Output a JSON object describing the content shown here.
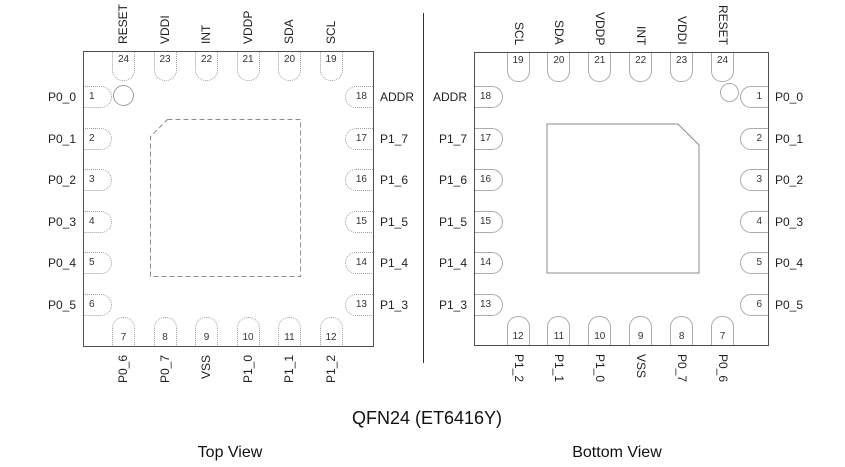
{
  "title": "QFN24 (ET6416Y)",
  "colors": {
    "package_border": "#4f4f4f",
    "pin_outline_top_view": "#9d9d9d",
    "pin_outline_bottom_view": "#ababab",
    "pad_line": "#8c8c8c",
    "divider": "#333333",
    "text": "#1f1f1f",
    "pin_number": "#333333",
    "background": "#ffffff"
  },
  "views": [
    {
      "caption": "Top View",
      "pin_style": "dotted",
      "pad_style": "dashed",
      "top_pins": [
        {
          "num": "24",
          "label": "RESET"
        },
        {
          "num": "23",
          "label": "VDDI"
        },
        {
          "num": "22",
          "label": "INT"
        },
        {
          "num": "21",
          "label": "VDDP"
        },
        {
          "num": "20",
          "label": "SDA"
        },
        {
          "num": "19",
          "label": "SCL"
        }
      ],
      "left_pins": [
        {
          "num": "1",
          "label": "P0_0"
        },
        {
          "num": "2",
          "label": "P0_1"
        },
        {
          "num": "3",
          "label": "P0_2"
        },
        {
          "num": "4",
          "label": "P0_3"
        },
        {
          "num": "5",
          "label": "P0_4"
        },
        {
          "num": "6",
          "label": "P0_5"
        }
      ],
      "right_pins": [
        {
          "num": "18",
          "label": "ADDR"
        },
        {
          "num": "17",
          "label": "P1_7"
        },
        {
          "num": "16",
          "label": "P1_6"
        },
        {
          "num": "15",
          "label": "P1_5"
        },
        {
          "num": "14",
          "label": "P1_4"
        },
        {
          "num": "13",
          "label": "P1_3"
        }
      ],
      "bottom_pins": [
        {
          "num": "7",
          "label": "P0_6"
        },
        {
          "num": "8",
          "label": "P0_7"
        },
        {
          "num": "9",
          "label": "VSS"
        },
        {
          "num": "10",
          "label": "P1_0"
        },
        {
          "num": "11",
          "label": "P1_1"
        },
        {
          "num": "12",
          "label": "P1_2"
        }
      ]
    },
    {
      "caption": "Bottom View",
      "pin_style": "solid",
      "pad_style": "solid",
      "top_pins": [
        {
          "num": "19",
          "label": "SCL"
        },
        {
          "num": "20",
          "label": "SDA"
        },
        {
          "num": "21",
          "label": "VDDP"
        },
        {
          "num": "22",
          "label": "INT"
        },
        {
          "num": "23",
          "label": "VDDI"
        },
        {
          "num": "24",
          "label": "RESET"
        }
      ],
      "left_pins": [
        {
          "num": "18",
          "label": "ADDR"
        },
        {
          "num": "17",
          "label": "P1_7"
        },
        {
          "num": "16",
          "label": "P1_6"
        },
        {
          "num": "15",
          "label": "P1_5"
        },
        {
          "num": "14",
          "label": "P1_4"
        },
        {
          "num": "13",
          "label": "P1_3"
        }
      ],
      "right_pins": [
        {
          "num": "1",
          "label": "P0_0"
        },
        {
          "num": "2",
          "label": "P0_1"
        },
        {
          "num": "3",
          "label": "P0_2"
        },
        {
          "num": "4",
          "label": "P0_3"
        },
        {
          "num": "5",
          "label": "P0_4"
        },
        {
          "num": "6",
          "label": "P0_5"
        }
      ],
      "bottom_pins": [
        {
          "num": "12",
          "label": "P1_2"
        },
        {
          "num": "11",
          "label": "P1_1"
        },
        {
          "num": "10",
          "label": "P1_0"
        },
        {
          "num": "9",
          "label": "VSS"
        },
        {
          "num": "8",
          "label": "P0_7"
        },
        {
          "num": "7",
          "label": "P0_6"
        }
      ]
    }
  ]
}
